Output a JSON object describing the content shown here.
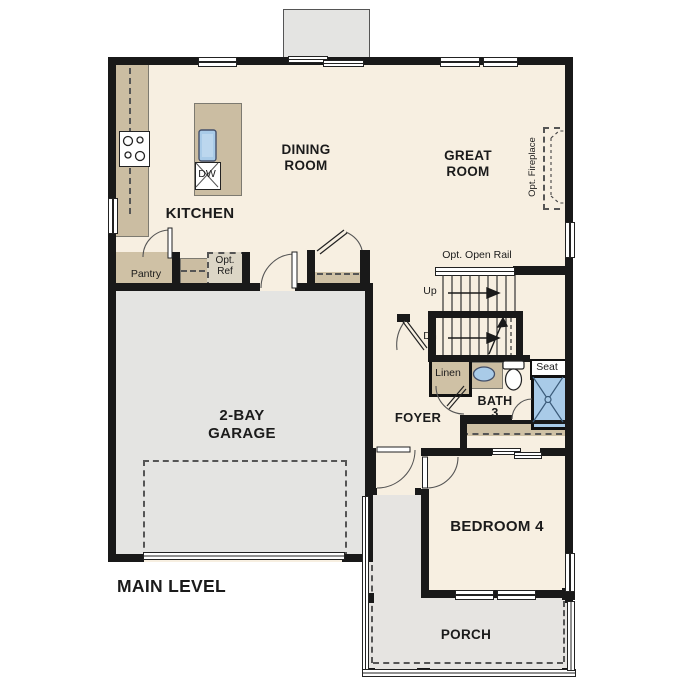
{
  "title": "MAIN LEVEL",
  "rooms": {
    "kitchen": "KITCHEN",
    "dining": "DINING\nROOM",
    "great": "GREAT\nROOM",
    "garage": "2-BAY\nGARAGE",
    "foyer": "FOYER",
    "bath": "BATH",
    "bath_number": "3",
    "bedroom": "BEDROOM 4",
    "porch": "PORCH"
  },
  "features": {
    "pantry": "Pantry",
    "opt_ref": "Opt.\nRef",
    "dishwasher": "DW",
    "linen": "Linen",
    "seat": "Seat",
    "open_rail": "Opt. Open Rail",
    "stairs_up": "Up",
    "stairs_down": "Dn",
    "fireplace": "Opt. Fireplace"
  },
  "colors": {
    "floor": "#f7efe1",
    "garage": "#e4e4e2",
    "porch": "#e6e4e1",
    "cabinet": "#cfc1a5",
    "fixture_blue": "#a9cbe8",
    "wall": "#191919"
  }
}
